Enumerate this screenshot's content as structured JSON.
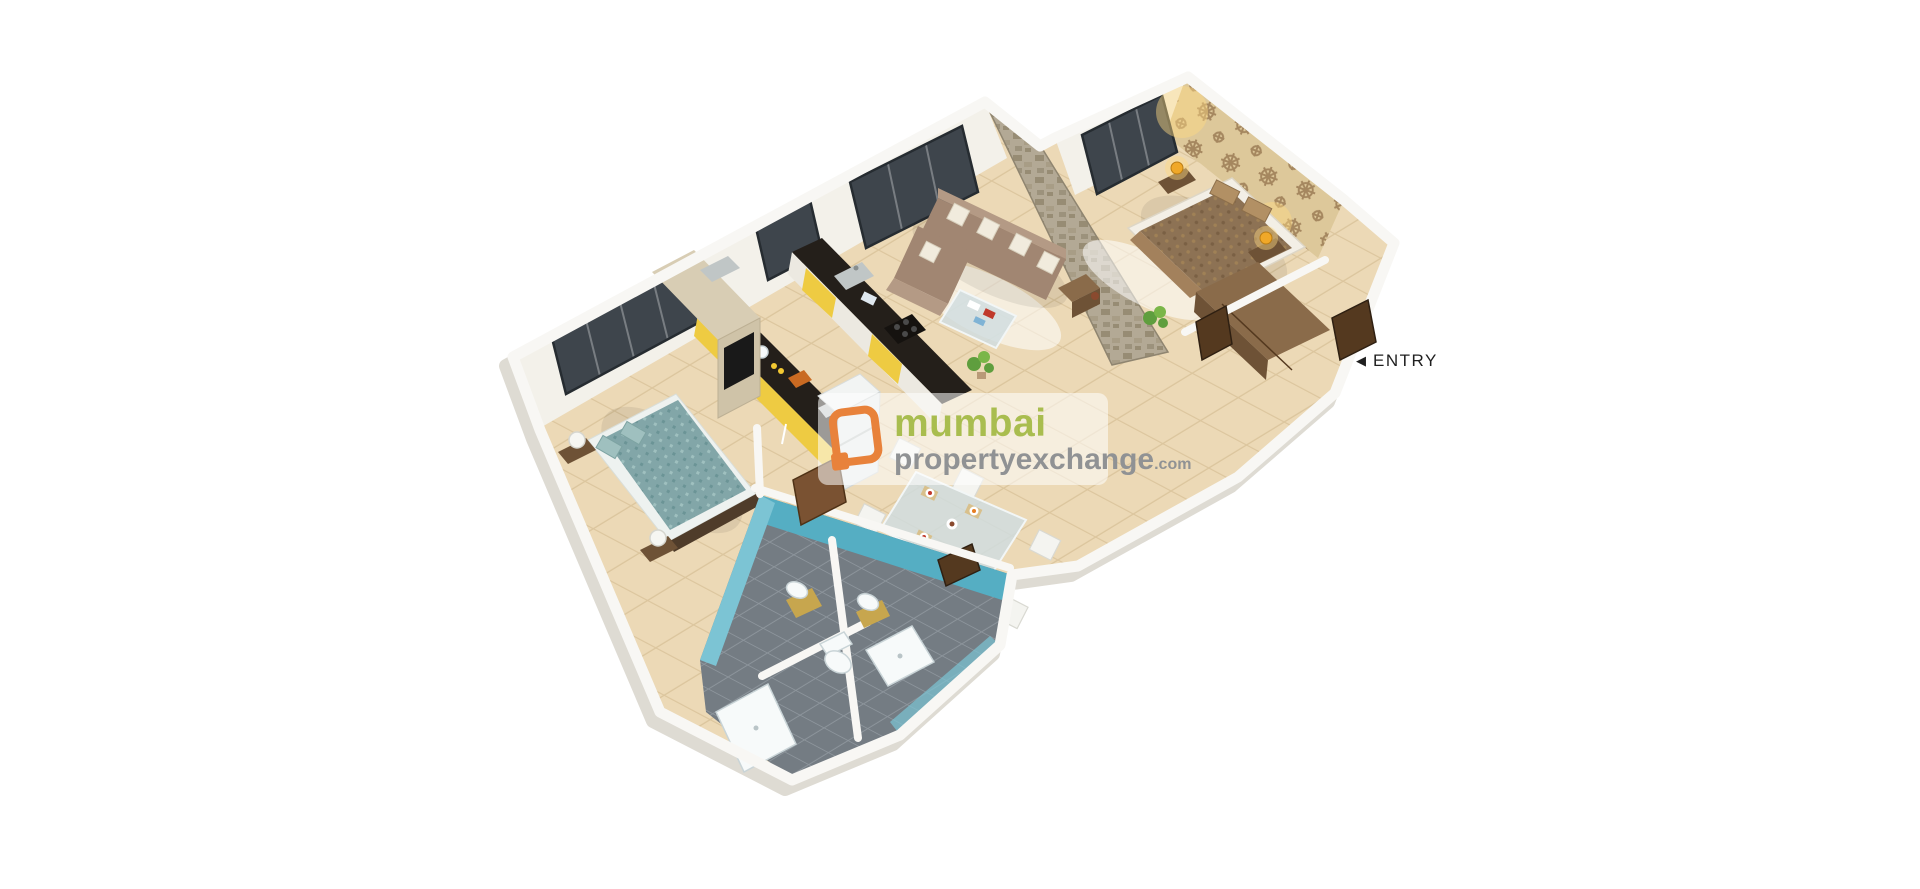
{
  "page": {
    "background": "#ffffff"
  },
  "plan": {
    "type": "3d-isometric-floor-plan",
    "rooms": [
      "living-room",
      "master-bedroom",
      "second-bedroom",
      "kitchen",
      "dining-area",
      "bathroom-left",
      "bathroom-right",
      "passage",
      "entry-corridor"
    ]
  },
  "entry": {
    "arrow": "◀",
    "label": "ENTRY",
    "color": "#1f1f1f"
  },
  "watermark": {
    "line1": "mumbai",
    "line2": "propertyexchange",
    "suffix": ".com",
    "icon": "orange-frame-logo",
    "colors": {
      "icon": "#e8823b",
      "line1": "#a9bd4f",
      "line2": "#909294",
      "panel": "rgba(255,255,255,0.55)"
    }
  },
  "palette": {
    "floor": "#ecd9b6",
    "floor_line": "#dcc69e",
    "wall": "#f8f7f4",
    "wall_face": "#f3f1ea",
    "wall_shadow": "#dedbd3",
    "glass": "#3e454c",
    "wallpaper": "#ddc89a",
    "wallpaper_motif": "#a5875f",
    "stone": "#b3a995",
    "stone_dark": "#978c74",
    "sofa": "#a18672",
    "sofa_light": "#b49a85",
    "master_bed": "#8d7254",
    "teal_bed": "#82a6a8",
    "bath_wall": "#55aec3",
    "bath_wall_light": "#7cc4d4",
    "bath_floor": "#747c83",
    "bath_floor_line": "#8d959c",
    "kitchen_counter": "#241f1a",
    "kitchen_yellow": "#eecb42",
    "wood_dark": "#6e5236",
    "wood_mid": "#8a6b4a",
    "wood_light": "#d8cdb4",
    "fixture_white": "#f7fafa",
    "lamp_amber": "#f0a828",
    "lamp_glow": "#ffd982",
    "plant_green": "#5f9e3e",
    "vanity_gold": "#c7a64e",
    "door_brown": "#54391f",
    "wm_green": "#a9bd4f",
    "wm_gray": "#909294",
    "wm_panel": "rgba(255,255,255,0.55)",
    "entry_color": "#1f1f1f"
  }
}
